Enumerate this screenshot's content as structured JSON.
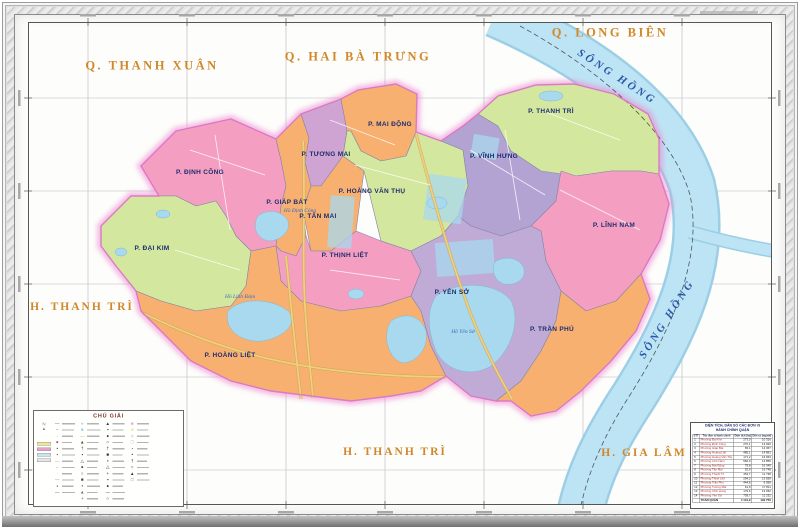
{
  "outside_labels": {
    "top_left": "Q. THANH XUÂN",
    "top_center": "Q. HAI BÀ TRƯNG",
    "top_right": "Q. LONG BIÊN",
    "left": "H. THANH TRÌ",
    "bottom_center": "H. THANH TRÌ",
    "bottom_right": "H. GIA LÂM"
  },
  "river_labels": {
    "top": "SÔNG  HỒNG",
    "side": "SÔNG  HỒNG"
  },
  "wards": {
    "dinh_cong": "P. ĐỊNH CÔNG",
    "dai_kim": "P. ĐẠI KIM",
    "giap_bat": "P. GIÁP BÁT",
    "tuong_mai": "P. TƯƠNG MAI",
    "tan_mai": "P. TÂN MAI",
    "thinh_liet": "P. THỊNH LIỆT",
    "mai_dong": "P. MAI ĐỘNG",
    "hoang_van_thu": "P. HOÀNG VĂN THỤ",
    "vinh_hung": "P. VĨNH HƯNG",
    "thanh_tri": "P. THANH TRÌ",
    "linh_nam": "P. LĨNH NAM",
    "yen_so": "P. YÊN SỞ",
    "tran_phu": "P. TRẦN PHÚ",
    "hoang_liet": "P. HOÀNG LIỆT"
  },
  "water_labels": {
    "linh_dam": "Hồ Linh Đàm",
    "dinh_cong": "Hồ Định Công",
    "yen_so": "Hồ Yên Sở"
  },
  "legend": {
    "title": "CHÚ GIẢI",
    "columns": [
      [
        {
          "g": "—",
          "c": "#444",
          "w": 26
        },
        {
          "g": "–",
          "c": "#666",
          "w": 24
        },
        {
          "g": "·",
          "c": "#444",
          "w": 22
        },
        {
          "g": "●",
          "c": "#b5306a",
          "w": 20
        },
        {
          "g": "•",
          "c": "#444",
          "w": 24
        },
        {
          "g": "▪",
          "c": "#7a5c2e",
          "w": 26
        },
        {
          "g": "—",
          "c": "#999",
          "w": 22
        },
        {
          "g": "–",
          "c": "#999",
          "w": 25
        },
        {
          "g": "·",
          "c": "#777",
          "w": 20
        },
        {
          "g": "—",
          "c": "#b08c3a",
          "w": 24
        },
        {
          "g": "▪",
          "c": "#444",
          "w": 23
        },
        {
          "g": "—",
          "c": "#444",
          "w": 26
        }
      ],
      [
        {
          "g": "≈",
          "c": "#4a90c4",
          "w": 24
        },
        {
          "g": "■",
          "c": "#9ad0e8",
          "w": 27
        },
        {
          "g": "—",
          "c": "#d4a017",
          "w": 25
        },
        {
          "g": "▲",
          "c": "#444",
          "w": 23
        },
        {
          "g": "†",
          "c": "#444",
          "w": 21
        },
        {
          "g": "▪",
          "c": "#444",
          "w": 25
        },
        {
          "g": "△",
          "c": "#444",
          "w": 22
        },
        {
          "g": "●",
          "c": "#444",
          "w": 20
        },
        {
          "g": "○",
          "c": "#444",
          "w": 24
        },
        {
          "g": "■",
          "c": "#444",
          "w": 23
        },
        {
          "g": "•",
          "c": "#444",
          "w": 26
        },
        {
          "g": "▲",
          "c": "#666",
          "w": 21
        },
        {
          "g": "+",
          "c": "#444",
          "w": 22
        }
      ],
      [
        {
          "g": "▲",
          "c": "#333",
          "w": 24
        },
        {
          "g": "▪",
          "c": "#333",
          "w": 22
        },
        {
          "g": "●",
          "c": "#333",
          "w": 25
        },
        {
          "g": "○",
          "c": "#333",
          "w": 21
        },
        {
          "g": "†",
          "c": "#333",
          "w": 24
        },
        {
          "g": "■",
          "c": "#333",
          "w": 20
        },
        {
          "g": "•",
          "c": "#333",
          "w": 23
        },
        {
          "g": "△",
          "c": "#333",
          "w": 25
        },
        {
          "g": "+",
          "c": "#333",
          "w": 22
        },
        {
          "g": "▪",
          "c": "#333",
          "w": 24
        },
        {
          "g": "●",
          "c": "#333",
          "w": 21
        },
        {
          "g": "—",
          "c": "#333",
          "w": 25
        },
        {
          "g": "○",
          "c": "#333",
          "w": 23
        }
      ],
      [
        {
          "g": "■",
          "c": "#e8a0c8",
          "w": 24
        },
        {
          "g": "■",
          "c": "#f4e68c",
          "w": 22
        },
        {
          "g": "■",
          "c": "#c9e4f2",
          "w": 25
        },
        {
          "g": "□",
          "c": "#888",
          "w": 23
        },
        {
          "g": "▪",
          "c": "#7a9c3a",
          "w": 21
        },
        {
          "g": "•",
          "c": "#333",
          "w": 24
        },
        {
          "g": "†",
          "c": "#333",
          "w": 20
        },
        {
          "g": "○",
          "c": "#333",
          "w": 24
        },
        {
          "g": "▲",
          "c": "#333",
          "w": 22
        },
        {
          "g": "□",
          "c": "#555",
          "w": 25
        }
      ]
    ]
  },
  "table": {
    "title_line1": "DIỆN TÍCH, DÂN SỐ CÁC ĐƠN VỊ",
    "title_line2": "HÀNH CHÍNH QUẬN",
    "headers": [
      "STT",
      "Tên đơn vị hành chính",
      "Diện tích (ha)",
      "Dân số (người)"
    ],
    "rows": [
      [
        "1",
        "Phường Đại Kim",
        "273,0",
        "10 316"
      ],
      [
        "2",
        "Phường Định Công",
        "270,1",
        "14 920"
      ],
      [
        "3",
        "Phường Giáp Bát",
        "65,1",
        "14 367"
      ],
      [
        "4",
        "Phường Hoàng Liệt",
        "485,1",
        "14 891"
      ],
      [
        "5",
        "Phường Hoàng Văn Thụ",
        "171,2",
        "16 663"
      ],
      [
        "6",
        "Phường Lĩnh Nam",
        "560,0",
        "14 856"
      ],
      [
        "7",
        "Phường Mai Động",
        "79,8",
        "16 345"
      ],
      [
        "8",
        "Phường Tân Mai",
        "52,9",
        "16 748"
      ],
      [
        "9",
        "Phường Thanh Trì",
        "454,7",
        "11 738"
      ],
      [
        "10",
        "Phường Thịnh Liệt",
        "294,2",
        "13 559"
      ],
      [
        "11",
        "Phường Trần Phú",
        "444,6",
        "6 058"
      ],
      [
        "12",
        "Phường Tương Mai",
        "61,9",
        "17 811"
      ],
      [
        "13",
        "Phường Vĩnh Hưng",
        "179,6",
        "13 252"
      ],
      [
        "14",
        "Phường Yên Sở",
        "739,7",
        "11 232"
      ]
    ],
    "total": [
      "",
      "TOÀN QUẬN",
      "4 131,9",
      "192 756"
    ]
  },
  "palette": {
    "pink": "#f49fc1",
    "orange": "#f8b071",
    "green": "#d4e79e",
    "purple": "#b3a3d2",
    "purple_light": "#c0abd6",
    "mauve": "#cfa3d2",
    "water": "#a9d9ee",
    "river": "#bde4f4",
    "river_edge": "#9ccfe6",
    "boundary_glow": "#ec86d2",
    "boundary_line": "#df76c4",
    "neighbor_label": "#d0882a",
    "ward_label": "#1e2d6e",
    "water_label": "#3a6ab8",
    "road_yellow": "#f0cf7e",
    "road_casing": "#c9a850"
  }
}
